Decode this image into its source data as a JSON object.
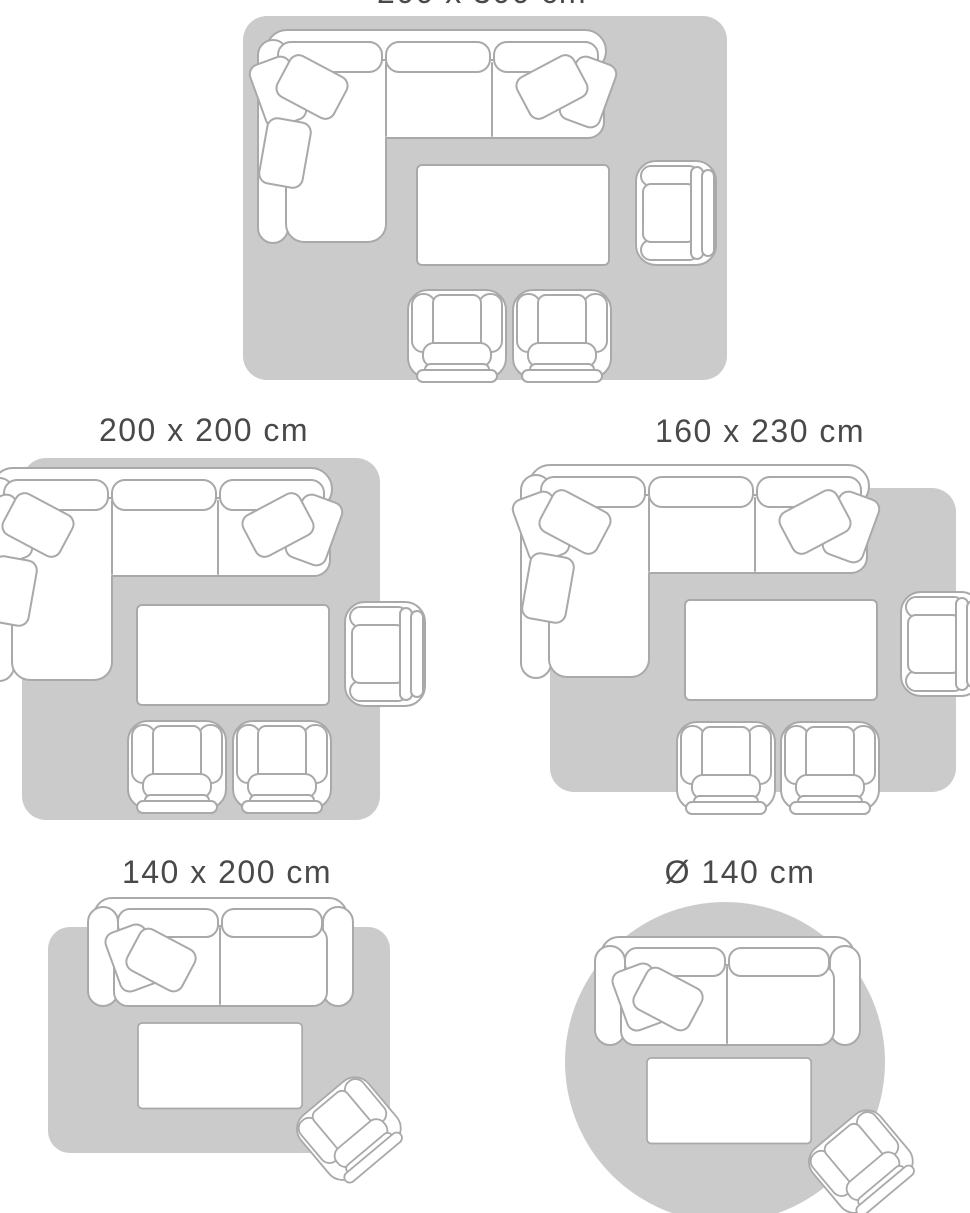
{
  "title": "Rug size guide with living room furniture layouts",
  "colors": {
    "background": "#ffffff",
    "rug": "#cbcbcb",
    "outline": "#a9a9a9",
    "furniture": "#ffffff",
    "caption": "#494949"
  },
  "layouts": [
    {
      "label": "200 x 300 cm",
      "rug_shape": "rectangular",
      "furniture": [
        "corner sofa with cushions",
        "coffee table",
        "armchair",
        "club chair",
        "club chair"
      ]
    },
    {
      "label": "200 x 200 cm",
      "rug_shape": "rectangular",
      "furniture": [
        "corner sofa with cushions",
        "coffee table",
        "armchair",
        "club chair",
        "club chair"
      ]
    },
    {
      "label": "160 x 230 cm",
      "rug_shape": "rectangular",
      "furniture": [
        "corner sofa with cushions",
        "coffee table",
        "armchair",
        "club chair",
        "club chair"
      ]
    },
    {
      "label": "140 x 200 cm",
      "rug_shape": "rectangular",
      "furniture": [
        "two-seat sofa with cushions",
        "coffee table",
        "angled armchair"
      ]
    },
    {
      "label": "Ø 140 cm",
      "rug_shape": "round",
      "furniture": [
        "two-seat sofa with cushions",
        "coffee table",
        "angled armchair"
      ]
    }
  ]
}
